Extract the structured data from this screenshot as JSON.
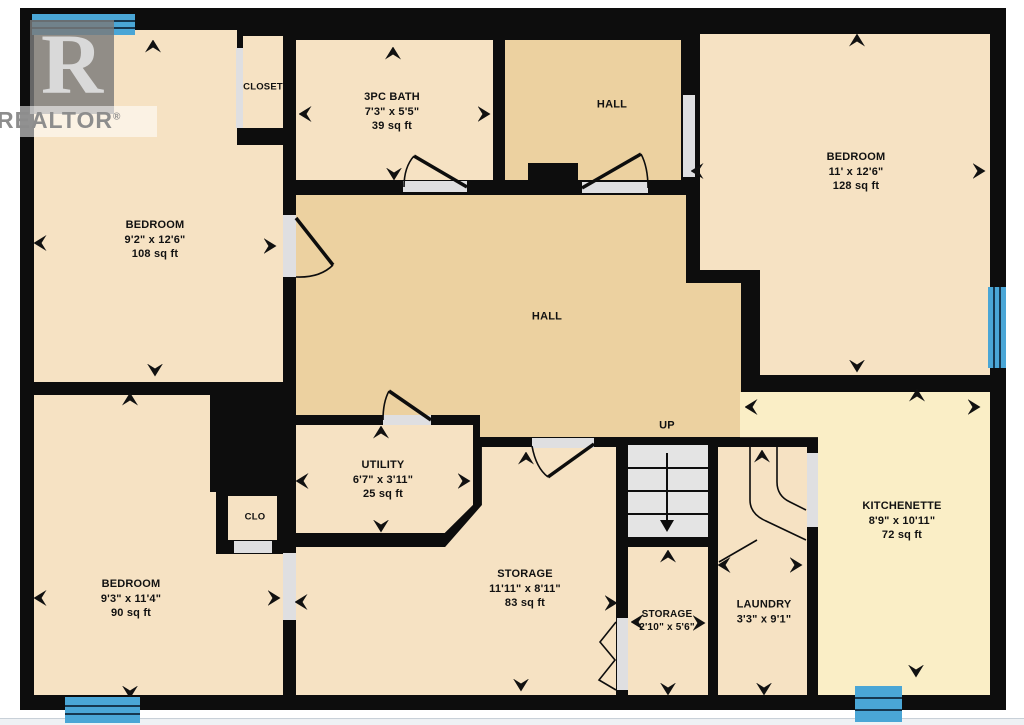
{
  "title": "Basement floor plan",
  "watermark": {
    "letter": "R",
    "word": "REALTOR",
    "reg": "®"
  },
  "colors": {
    "wall": "#0d0d0d",
    "room": "#f6e2c3",
    "hall": "#ecd1a0",
    "kitchen": "#faeec6",
    "opening": "#dfdfe1",
    "stair": "#e4e4e4",
    "window": "#4aa6d6",
    "window_line": "#16374f",
    "label": "#111111"
  },
  "base": {
    "x": 20,
    "y": 8,
    "w": 986,
    "h": 702
  },
  "floors": [
    {
      "id": "floor-bedroom-top-left",
      "x": 34,
      "y": 30,
      "w": 203,
      "h": 352,
      "fill": "room"
    },
    {
      "id": "floor-bedroom-top-left-ext",
      "x": 237,
      "y": 145,
      "w": 46,
      "h": 237,
      "fill": "room"
    },
    {
      "id": "floor-closet-top",
      "x": 243,
      "y": 36,
      "w": 40,
      "h": 92,
      "fill": "room"
    },
    {
      "id": "floor-bath",
      "x": 296,
      "y": 40,
      "w": 197,
      "h": 140,
      "fill": "room"
    },
    {
      "id": "floor-hall-top",
      "x": 505,
      "y": 40,
      "w": 176,
      "h": 140,
      "fill": "hall"
    },
    {
      "id": "floor-bedroom-top-right-a",
      "x": 700,
      "y": 34,
      "w": 290,
      "h": 236,
      "fill": "room"
    },
    {
      "id": "floor-bedroom-top-right-b",
      "x": 760,
      "y": 270,
      "w": 230,
      "h": 105,
      "fill": "room"
    },
    {
      "id": "floor-hall-main",
      "x": 296,
      "y": 195,
      "w": 390,
      "h": 220,
      "fill": "hall"
    },
    {
      "id": "floor-hall-lower",
      "x": 480,
      "y": 415,
      "w": 206,
      "h": 22,
      "fill": "hall"
    },
    {
      "id": "floor-hall-ext",
      "x": 686,
      "y": 283,
      "w": 55,
      "h": 154,
      "fill": "hall"
    },
    {
      "id": "floor-utility",
      "x": 296,
      "y": 425,
      "w": 177,
      "h": 108,
      "fill": "room",
      "clip": "polygon(0 0, 100% 0, 100% 74%, 84% 100%, 0 100%)"
    },
    {
      "id": "floor-storage",
      "x": 296,
      "y": 447,
      "w": 320,
      "h": 248,
      "fill": "room",
      "clip": "polygon(58.1% 0, 100% 0, 100% 100%, 0 100%, 0 40.3%, 46.6% 40.3%, 58.1% 23.4%)"
    },
    {
      "id": "floor-bedroom-bottom-left",
      "x": 34,
      "y": 395,
      "w": 249,
      "h": 300,
      "fill": "room"
    },
    {
      "id": "floor-storage-small",
      "x": 628,
      "y": 547,
      "w": 80,
      "h": 148,
      "fill": "room"
    },
    {
      "id": "floor-laundry",
      "x": 718,
      "y": 447,
      "w": 89,
      "h": 248,
      "fill": "room"
    },
    {
      "id": "floor-kitchenette",
      "x": 740,
      "y": 392,
      "w": 250,
      "h": 303,
      "fill": "kitchen",
      "clip": "polygon(0 0, 100% 0, 100% 100%, 31.2% 100%, 31.2% 14.9%, 0 14.9%)"
    }
  ],
  "solids": [
    {
      "id": "wall-chimney-bump",
      "x": 528,
      "y": 163,
      "w": 50,
      "h": 32
    },
    {
      "id": "wall-block-bottom-left",
      "x": 210,
      "y": 390,
      "w": 86,
      "h": 102
    },
    {
      "id": "wall-clo-box",
      "x": 216,
      "y": 490,
      "w": 67,
      "h": 64
    },
    {
      "id": "wall-nub-kitchenette",
      "x": 741,
      "y": 358,
      "w": 19,
      "h": 34
    }
  ],
  "inner_floors": [
    {
      "id": "floor-clo",
      "x": 228,
      "y": 496,
      "w": 49,
      "h": 44,
      "fill": "room"
    }
  ],
  "openings": [
    {
      "id": "opening-closet-top",
      "x": 236,
      "y": 48,
      "w": 7,
      "h": 80
    },
    {
      "id": "opening-bedroom-top-left",
      "x": 283,
      "y": 215,
      "w": 13,
      "h": 62
    },
    {
      "id": "opening-bath-door",
      "x": 403,
      "y": 181,
      "w": 64,
      "h": 11
    },
    {
      "id": "opening-hall-top-door",
      "x": 582,
      "y": 182,
      "w": 66,
      "h": 11
    },
    {
      "id": "opening-bedroom-top-right",
      "x": 683,
      "y": 95,
      "w": 12,
      "h": 82
    },
    {
      "id": "opening-utility-door",
      "x": 383,
      "y": 415,
      "w": 48,
      "h": 10
    },
    {
      "id": "opening-storage-door",
      "x": 532,
      "y": 438,
      "w": 62,
      "h": 10
    },
    {
      "id": "opening-bedroom-bottom-left",
      "x": 283,
      "y": 553,
      "w": 13,
      "h": 67
    },
    {
      "id": "opening-clo",
      "x": 234,
      "y": 541,
      "w": 38,
      "h": 12
    },
    {
      "id": "opening-kitchenette-side",
      "x": 807,
      "y": 453,
      "w": 11,
      "h": 74
    },
    {
      "id": "opening-storage-small-bifold",
      "x": 617,
      "y": 618,
      "w": 11,
      "h": 72
    }
  ],
  "windows": [
    {
      "id": "window-top-left",
      "x": 32,
      "y": 14,
      "w": 103,
      "h": 21,
      "orient": "h"
    },
    {
      "id": "window-right",
      "x": 988,
      "y": 287,
      "w": 18,
      "h": 81,
      "orient": "v"
    },
    {
      "id": "window-bottom-left",
      "x": 65,
      "y": 697,
      "w": 75,
      "h": 26,
      "orient": "h"
    },
    {
      "id": "window-bottom-right",
      "x": 855,
      "y": 686,
      "w": 47,
      "h": 36,
      "orient": "h"
    }
  ],
  "stairs": {
    "id": "staircase",
    "box": {
      "x": 628,
      "y": 445,
      "w": 80,
      "h": 92
    },
    "treads_y": [
      468,
      491,
      514
    ],
    "arrow": {
      "x": 667,
      "y1": 453,
      "y2": 520
    }
  },
  "doors": [
    {
      "id": "door-bedroom-top-left",
      "leaf": "M 296 218 L 333 265",
      "arc": "M 296 277 Q 320 278 333 265"
    },
    {
      "id": "door-bath",
      "leaf": "M 467 187 L 414 156",
      "arc": "M 404 187 Q 404 167 414 156"
    },
    {
      "id": "door-hall-top",
      "leaf": "M 582 188 L 641 154",
      "arc": "M 648 188 Q 648 167 641 154"
    },
    {
      "id": "door-utility",
      "leaf": "M 431 420 L 389 391",
      "arc": "M 383 420 Q 383 402 389 391"
    },
    {
      "id": "door-storage",
      "leaf": "M 594 444 L 548 477",
      "arc": "M 532 446 Q 536 468 548 477"
    }
  ],
  "thin_lines": [
    {
      "id": "winder-tread-1",
      "d": "M 750 447 L 750 500 Q 750 514 766 521 L 806 540"
    },
    {
      "id": "winder-tread-2",
      "d": "M 777 447 L 777 482 Q 777 496 790 502 L 806 510"
    },
    {
      "id": "winder-tread-3",
      "d": "M 757 540 L 719 562"
    },
    {
      "id": "bifold-door",
      "d": "M 616 622 L 600 642 L 615 660 L 599 680 L 616 690"
    }
  ],
  "arrows": [
    {
      "x": 153,
      "y": 46,
      "dir": "up"
    },
    {
      "x": 40,
      "y": 243,
      "dir": "left"
    },
    {
      "x": 270,
      "y": 246,
      "dir": "right"
    },
    {
      "x": 155,
      "y": 370,
      "dir": "down"
    },
    {
      "x": 393,
      "y": 53,
      "dir": "up"
    },
    {
      "x": 305,
      "y": 114,
      "dir": "left"
    },
    {
      "x": 484,
      "y": 114,
      "dir": "right"
    },
    {
      "x": 394,
      "y": 174,
      "dir": "down"
    },
    {
      "x": 857,
      "y": 40,
      "dir": "up"
    },
    {
      "x": 697,
      "y": 171,
      "dir": "left"
    },
    {
      "x": 979,
      "y": 171,
      "dir": "right"
    },
    {
      "x": 857,
      "y": 366,
      "dir": "down"
    },
    {
      "x": 381,
      "y": 432,
      "dir": "up"
    },
    {
      "x": 302,
      "y": 481,
      "dir": "left"
    },
    {
      "x": 464,
      "y": 481,
      "dir": "right"
    },
    {
      "x": 381,
      "y": 526,
      "dir": "down"
    },
    {
      "x": 526,
      "y": 458,
      "dir": "up"
    },
    {
      "x": 301,
      "y": 602,
      "dir": "left"
    },
    {
      "x": 611,
      "y": 603,
      "dir": "right"
    },
    {
      "x": 521,
      "y": 685,
      "dir": "down"
    },
    {
      "x": 668,
      "y": 556,
      "dir": "up"
    },
    {
      "x": 637,
      "y": 622,
      "dir": "left"
    },
    {
      "x": 699,
      "y": 623,
      "dir": "right"
    },
    {
      "x": 668,
      "y": 689,
      "dir": "down"
    },
    {
      "x": 762,
      "y": 456,
      "dir": "up"
    },
    {
      "x": 724,
      "y": 565,
      "dir": "left"
    },
    {
      "x": 796,
      "y": 565,
      "dir": "right"
    },
    {
      "x": 764,
      "y": 689,
      "dir": "down"
    },
    {
      "x": 917,
      "y": 395,
      "dir": "up"
    },
    {
      "x": 751,
      "y": 407,
      "dir": "left"
    },
    {
      "x": 974,
      "y": 407,
      "dir": "right"
    },
    {
      "x": 916,
      "y": 671,
      "dir": "down"
    },
    {
      "x": 130,
      "y": 399,
      "dir": "up"
    },
    {
      "x": 40,
      "y": 598,
      "dir": "left"
    },
    {
      "x": 274,
      "y": 598,
      "dir": "right"
    },
    {
      "x": 130,
      "y": 692,
      "dir": "down"
    }
  ],
  "labels": [
    {
      "id": "label-closet-top",
      "x": 263,
      "y": 88,
      "size": 9.5,
      "lines": [
        "CLOSET"
      ]
    },
    {
      "id": "label-bath",
      "x": 392,
      "y": 112,
      "size": 11,
      "lines": [
        "3PC BATH",
        "7'3\" x 5'5\"",
        "39 sq ft"
      ]
    },
    {
      "id": "label-hall-top",
      "x": 612,
      "y": 105,
      "size": 11,
      "lines": [
        "HALL"
      ]
    },
    {
      "id": "label-bedroom-top-right",
      "x": 856,
      "y": 172,
      "size": 11,
      "lines": [
        "BEDROOM",
        "11' x 12'6\"",
        "128 sq ft"
      ]
    },
    {
      "id": "label-bedroom-top-left",
      "x": 155,
      "y": 240,
      "size": 11,
      "lines": [
        "BEDROOM",
        "9'2\" x 12'6\"",
        "108 sq ft"
      ]
    },
    {
      "id": "label-hall-main",
      "x": 547,
      "y": 317,
      "size": 11,
      "lines": [
        "HALL"
      ]
    },
    {
      "id": "label-up",
      "x": 667,
      "y": 426,
      "size": 11,
      "lines": [
        "UP"
      ]
    },
    {
      "id": "label-utility",
      "x": 383,
      "y": 480,
      "size": 11,
      "lines": [
        "UTILITY",
        "6'7\" x 3'11\"",
        "25 sq ft"
      ]
    },
    {
      "id": "label-clo",
      "x": 255,
      "y": 518,
      "size": 9.5,
      "lines": [
        "CLO"
      ]
    },
    {
      "id": "label-storage",
      "x": 525,
      "y": 589,
      "size": 11,
      "lines": [
        "STORAGE",
        "11'11\" x 8'11\"",
        "83 sq ft"
      ]
    },
    {
      "id": "label-bedroom-bottom-left",
      "x": 131,
      "y": 599,
      "size": 11,
      "lines": [
        "BEDROOM",
        "9'3\" x 11'4\"",
        "90 sq ft"
      ]
    },
    {
      "id": "label-storage-small",
      "x": 667,
      "y": 621,
      "size": 10,
      "lines": [
        "STORAGE",
        "2'10\" x 5'6\""
      ]
    },
    {
      "id": "label-laundry",
      "x": 764,
      "y": 612,
      "size": 11,
      "lines": [
        "LAUNDRY",
        "3'3\" x 9'1\""
      ]
    },
    {
      "id": "label-kitchenette",
      "x": 902,
      "y": 521,
      "size": 11,
      "lines": [
        "KITCHENETTE",
        "8'9\" x 10'11\"",
        "72 sq ft"
      ]
    }
  ]
}
